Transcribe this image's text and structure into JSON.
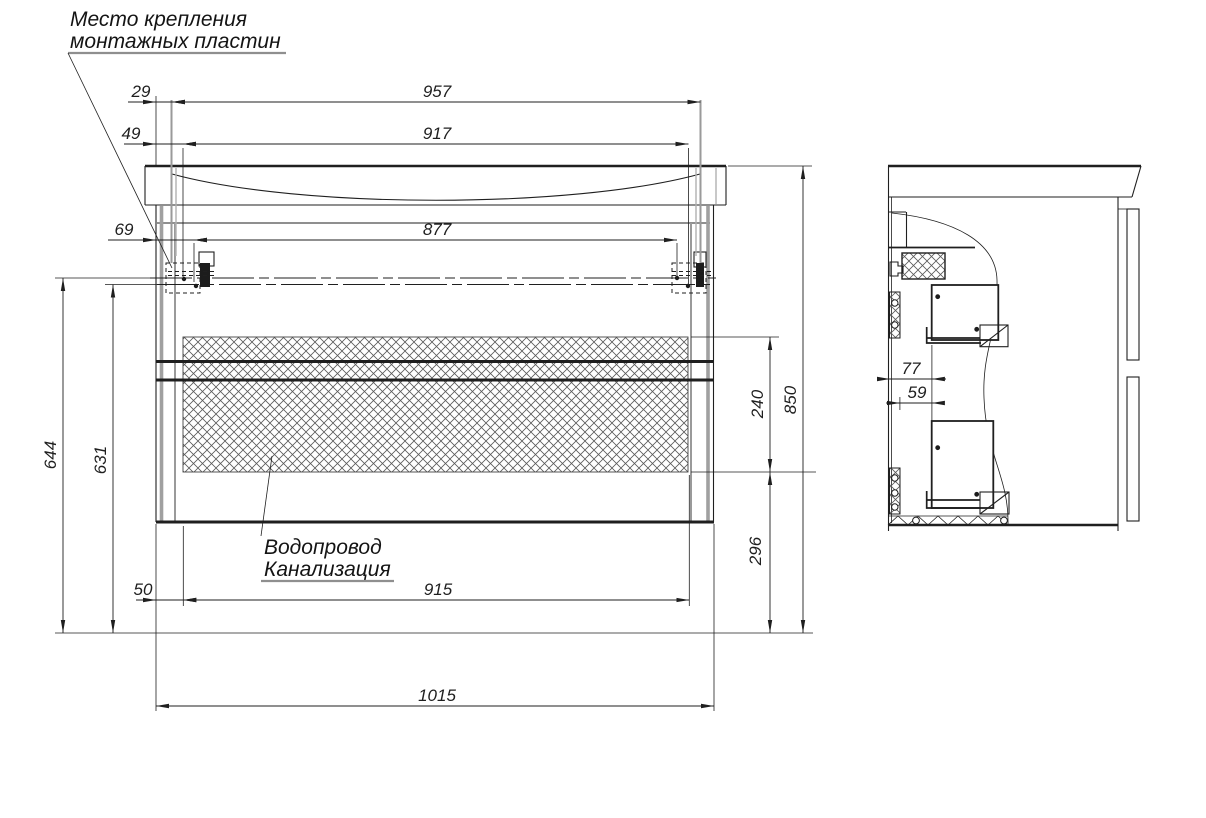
{
  "drawing": {
    "notes": {
      "mounting": {
        "line1": "Место крепления",
        "line2": "монтажных пластин"
      },
      "plumbing": {
        "line1": "Водопровод",
        "line2": "Канализация"
      }
    },
    "dims": {
      "d29": "29",
      "d49": "49",
      "d69": "69",
      "d957": "957",
      "d917": "917",
      "d877": "877",
      "d644": "644",
      "d631": "631",
      "d50": "50",
      "d915": "915",
      "d1015": "1015",
      "d240": "240",
      "d296": "296",
      "d850": "850",
      "d77": "77",
      "d59": "59"
    },
    "colors": {
      "line": "#1f1f1f",
      "gray_edge": "#a0a0a0",
      "background": "#ffffff"
    }
  }
}
